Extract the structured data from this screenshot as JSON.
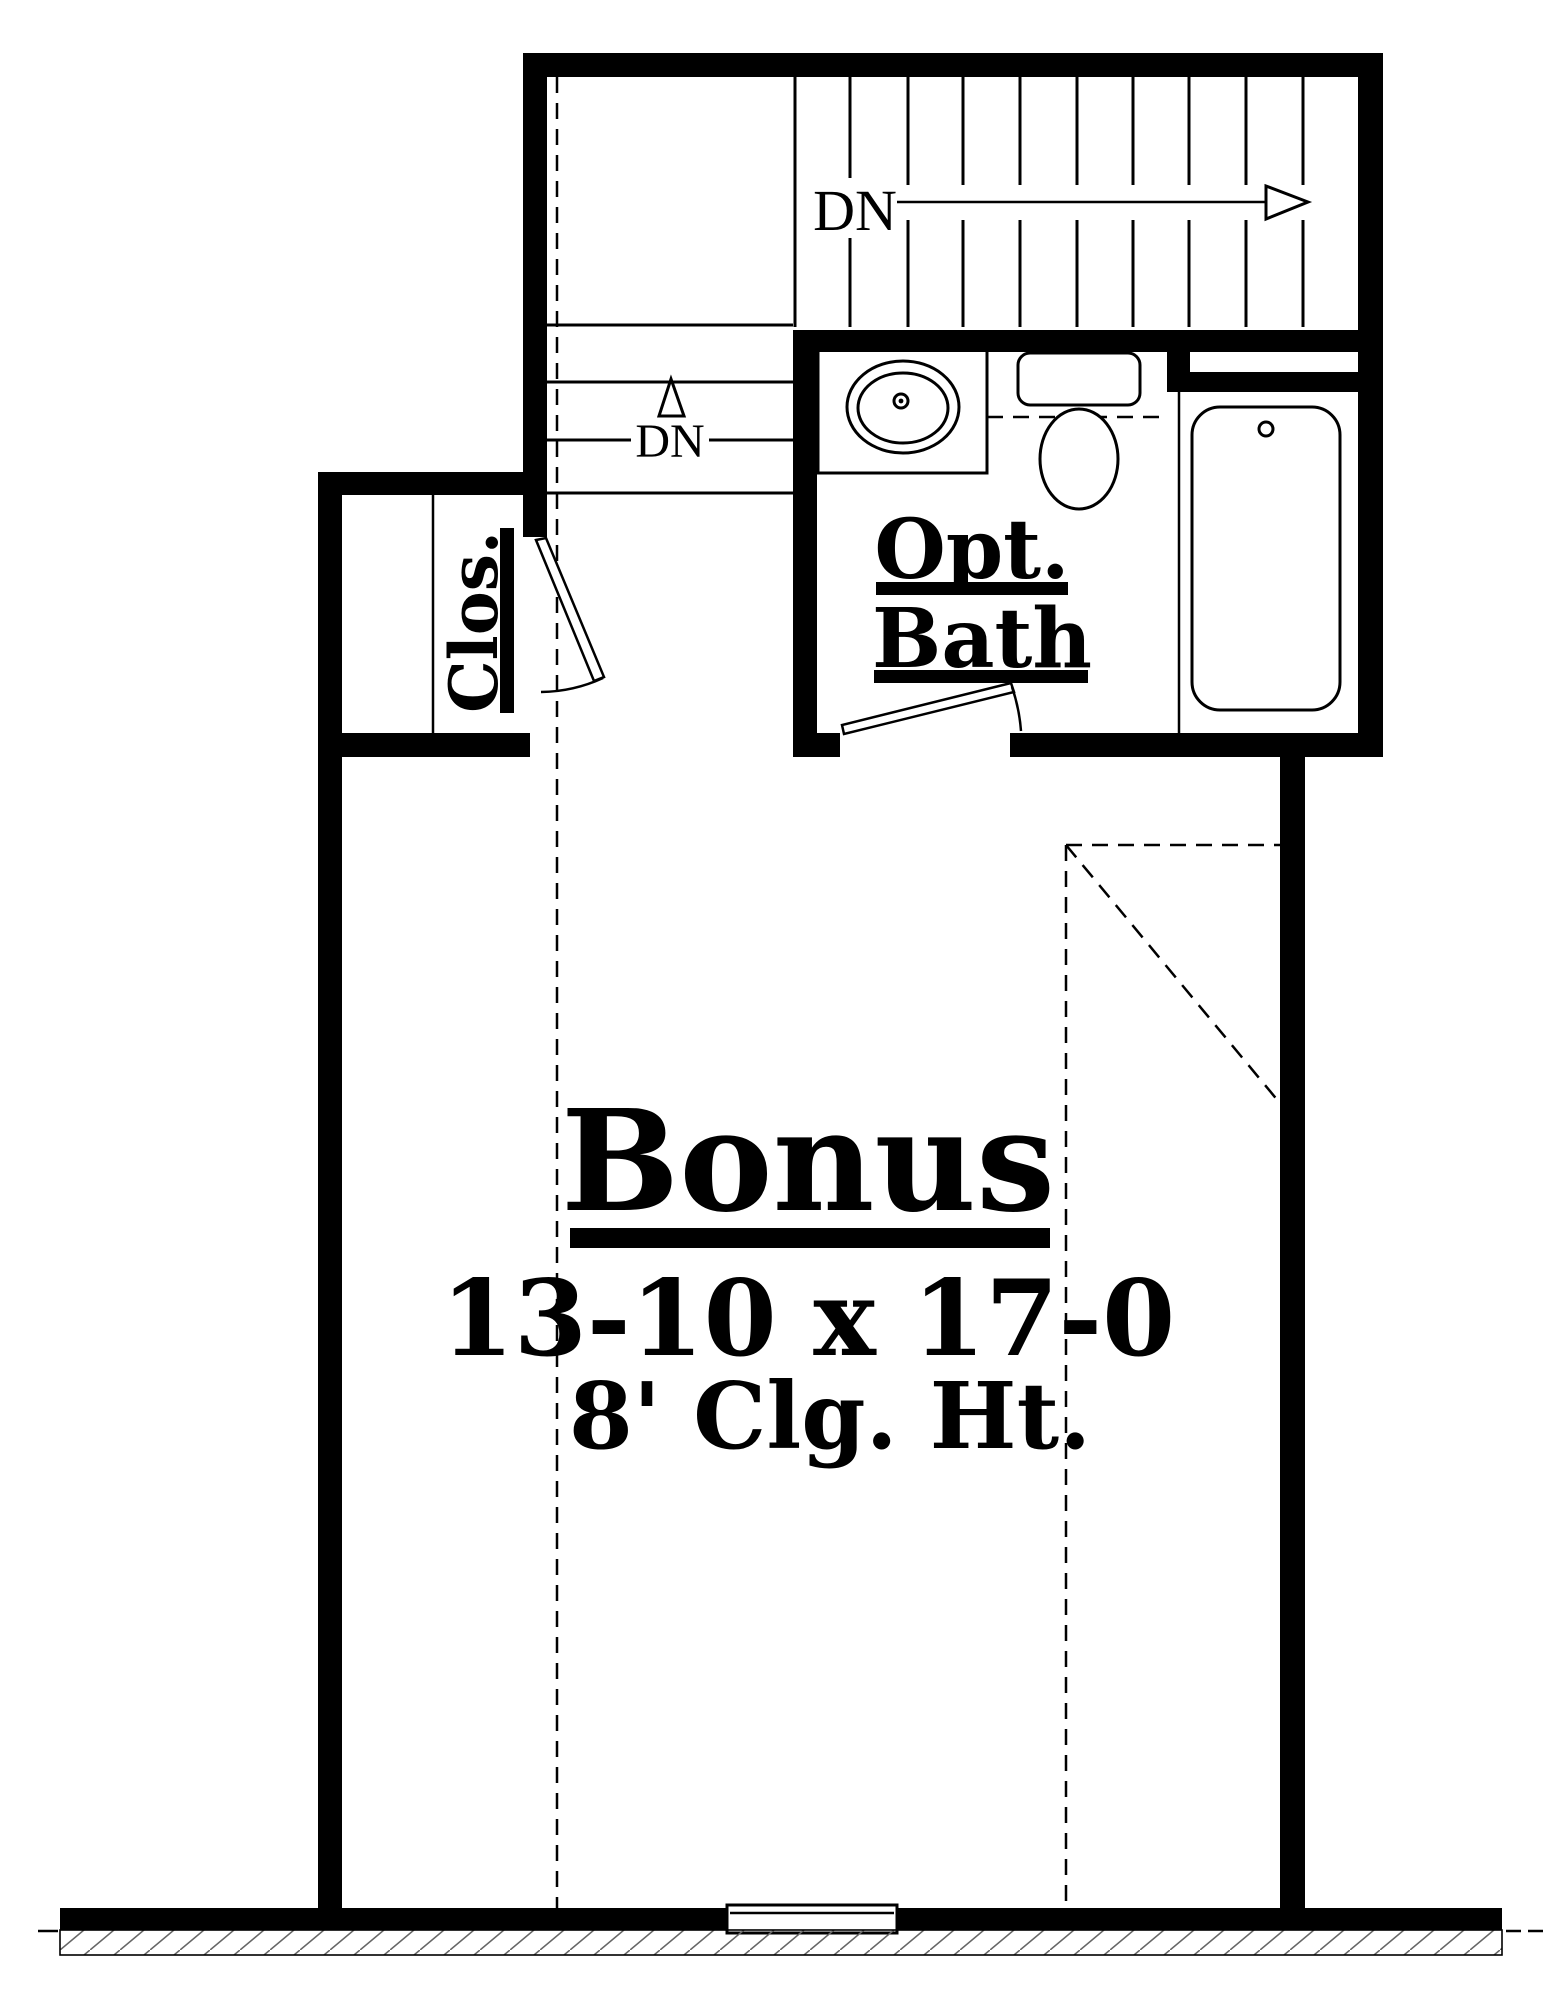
{
  "title": "Bonus Room Floor Plan",
  "labels": {
    "stairs_dn_upper": "DN",
    "stairs_dn_lower": "DN",
    "closet": "Clos.",
    "bath_line1": "Opt.",
    "bath_line2": "Bath",
    "room_name": "Bonus",
    "room_dimensions": "13-10 x 17-0",
    "ceiling_height": "8' Clg. Ht."
  },
  "colors": {
    "line": "#000000",
    "background": "#ffffff",
    "hatch": "#666666"
  }
}
